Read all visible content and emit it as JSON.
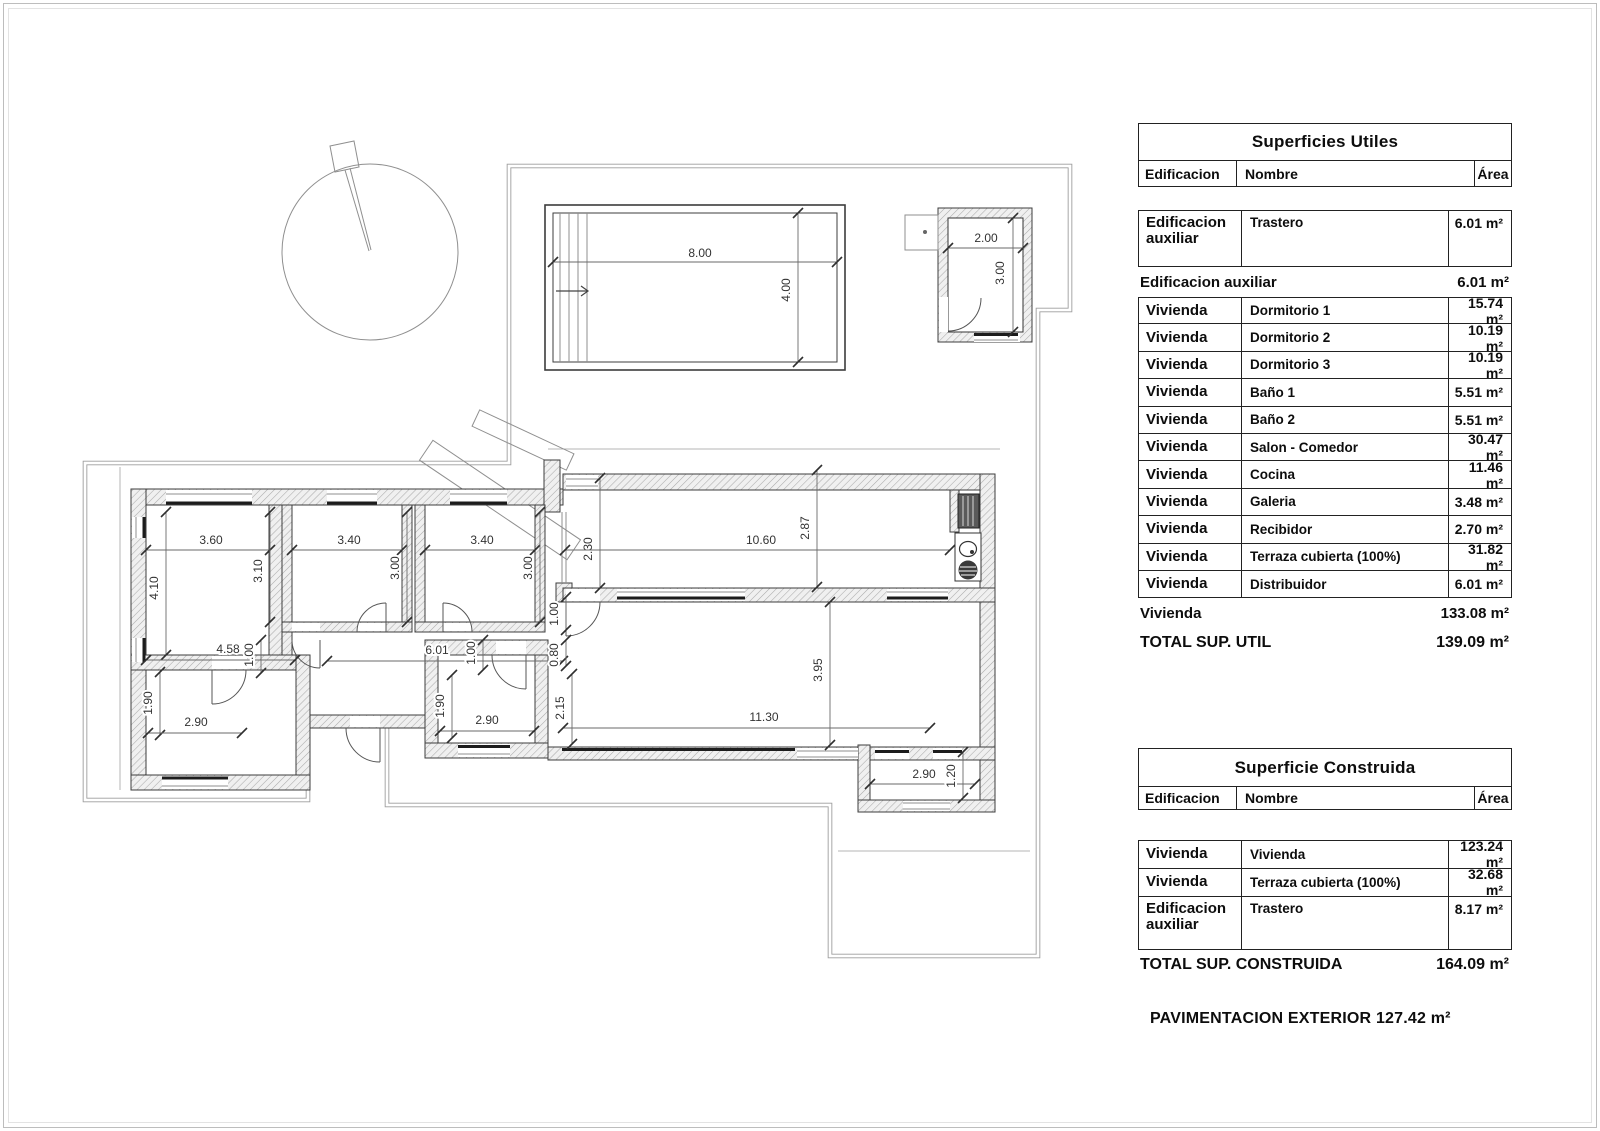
{
  "tables": {
    "utiles": {
      "title": "Superficies Utiles",
      "headers": {
        "edificacion": "Edificacion",
        "nombre": "Nombre",
        "area": "Área"
      },
      "rows": [
        {
          "type": "detail",
          "tall": true,
          "edificacion": "Edificacion auxiliar",
          "nombre": "Trastero",
          "area": "6.01 m²"
        },
        {
          "type": "subtotal",
          "label": "Edificacion auxiliar",
          "area": "6.01 m²"
        },
        {
          "type": "detail",
          "edificacion": "Vivienda",
          "nombre": "Dormitorio 1",
          "area": "15.74 m²"
        },
        {
          "type": "detail",
          "edificacion": "Vivienda",
          "nombre": "Dormitorio 2",
          "area": "10.19 m²"
        },
        {
          "type": "detail",
          "edificacion": "Vivienda",
          "nombre": "Dormitorio 3",
          "area": "10.19 m²"
        },
        {
          "type": "detail",
          "edificacion": "Vivienda",
          "nombre": "Baño 1",
          "area": "5.51 m²"
        },
        {
          "type": "detail",
          "edificacion": "Vivienda",
          "nombre": "Baño 2",
          "area": "5.51 m²"
        },
        {
          "type": "detail",
          "edificacion": "Vivienda",
          "nombre": "Salon - Comedor",
          "area": "30.47 m²"
        },
        {
          "type": "detail",
          "edificacion": "Vivienda",
          "nombre": "Cocina",
          "area": "11.46 m²"
        },
        {
          "type": "detail",
          "edificacion": "Vivienda",
          "nombre": "Galeria",
          "area": "3.48 m²"
        },
        {
          "type": "detail",
          "edificacion": "Vivienda",
          "nombre": "Recibidor",
          "area": "2.70 m²"
        },
        {
          "type": "detail",
          "edificacion": "Vivienda",
          "nombre": "Terraza cubierta (100%)",
          "area": "31.82 m²"
        },
        {
          "type": "detail",
          "edificacion": "Vivienda",
          "nombre": "Distribuidor",
          "area": "6.01 m²"
        },
        {
          "type": "subtotal",
          "label": "Vivienda",
          "area": "133.08 m²"
        },
        {
          "type": "total",
          "label": "TOTAL SUP. UTIL",
          "area": "139.09 m²"
        }
      ]
    },
    "construida": {
      "title": "Superficie Construida",
      "headers": {
        "edificacion": "Edificacion",
        "nombre": "Nombre",
        "area": "Área"
      },
      "rows": [
        {
          "type": "detail",
          "edificacion": "Vivienda",
          "nombre": "Vivienda",
          "area": "123.24 m²"
        },
        {
          "type": "detail",
          "edificacion": "Vivienda",
          "nombre": "Terraza cubierta (100%)",
          "area": "32.68 m²"
        },
        {
          "type": "detail",
          "tall": true,
          "edificacion": "Edificacion auxiliar",
          "nombre": "Trastero",
          "area": "8.17 m²"
        },
        {
          "type": "total",
          "label": "TOTAL SUP. CONSTRUIDA",
          "area": "164.09 m²"
        }
      ]
    }
  },
  "footer": {
    "pavimentacion": "PAVIMENTACION EXTERIOR 127.42 m²"
  },
  "plan": {
    "dimensions": [
      {
        "t": "8.00",
        "x1": 553,
        "y1": 262,
        "x2": 837,
        "y2": 262,
        "lx": 700,
        "ly": 257,
        "v": 0
      },
      {
        "t": "4.00",
        "x1": 798,
        "y1": 213,
        "x2": 798,
        "y2": 362,
        "lx": 790,
        "ly": 290,
        "v": 1
      },
      {
        "t": "2.00",
        "x1": 948,
        "y1": 248,
        "x2": 1023,
        "y2": 248,
        "lx": 986,
        "ly": 242,
        "v": 0
      },
      {
        "t": "3.00",
        "x1": 1013,
        "y1": 218,
        "x2": 1013,
        "y2": 332,
        "lx": 1004,
        "ly": 273,
        "v": 1
      },
      {
        "t": "3.60",
        "x1": 146,
        "y1": 550,
        "x2": 270,
        "y2": 550,
        "lx": 211,
        "ly": 544,
        "v": 0
      },
      {
        "t": "4.10",
        "x1": 166,
        "y1": 512,
        "x2": 166,
        "y2": 655,
        "lx": 158,
        "ly": 588,
        "v": 1
      },
      {
        "t": "3.10",
        "x1": 270,
        "y1": 512,
        "x2": 270,
        "y2": 622,
        "lx": 262,
        "ly": 571,
        "v": 1
      },
      {
        "t": "3.40",
        "x1": 292,
        "y1": 550,
        "x2": 402,
        "y2": 550,
        "lx": 349,
        "ly": 544,
        "v": 0
      },
      {
        "t": "3.00",
        "x1": 407,
        "y1": 512,
        "x2": 407,
        "y2": 622,
        "lx": 399,
        "ly": 568,
        "v": 1
      },
      {
        "t": "3.40",
        "x1": 425,
        "y1": 550,
        "x2": 535,
        "y2": 550,
        "lx": 482,
        "ly": 544,
        "v": 0
      },
      {
        "t": "3.00",
        "x1": 540,
        "y1": 512,
        "x2": 540,
        "y2": 622,
        "lx": 532,
        "ly": 568,
        "v": 1
      },
      {
        "t": "2.30",
        "x1": 600,
        "y1": 478,
        "x2": 600,
        "y2": 588,
        "lx": 592,
        "ly": 549,
        "v": 1
      },
      {
        "t": "10.60",
        "x1": 565,
        "y1": 550,
        "x2": 950,
        "y2": 550,
        "lx": 761,
        "ly": 544,
        "v": 0
      },
      {
        "t": "2.87",
        "x1": 817,
        "y1": 470,
        "x2": 817,
        "y2": 587,
        "lx": 809,
        "ly": 528,
        "v": 1
      },
      {
        "t": "4.58",
        "x1": 146,
        "y1": 660,
        "x2": 295,
        "y2": 660,
        "lx": 228,
        "ly": 653,
        "v": 0
      },
      {
        "t": "1.00",
        "x1": 261,
        "y1": 640,
        "x2": 261,
        "y2": 673,
        "lx": 253,
        "ly": 655,
        "v": 1
      },
      {
        "t": "6.01",
        "x1": 327,
        "y1": 661,
        "x2": 563,
        "y2": 661,
        "lx": 437,
        "ly": 654,
        "v": 0
      },
      {
        "t": "1.00",
        "x1": 483,
        "y1": 640,
        "x2": 483,
        "y2": 670,
        "lx": 475,
        "ly": 653,
        "v": 1
      },
      {
        "t": "1.00",
        "x1": 566,
        "y1": 597,
        "x2": 566,
        "y2": 630,
        "lx": 558,
        "ly": 614,
        "v": 1
      },
      {
        "t": "0.80",
        "x1": 566,
        "y1": 640,
        "x2": 566,
        "y2": 666,
        "lx": 558,
        "ly": 655,
        "v": 1
      },
      {
        "t": "3.95",
        "x1": 830,
        "y1": 602,
        "x2": 830,
        "y2": 745,
        "lx": 822,
        "ly": 670,
        "v": 1
      },
      {
        "t": "11.30",
        "x1": 563,
        "y1": 728,
        "x2": 930,
        "y2": 728,
        "lx": 764,
        "ly": 721,
        "v": 0
      },
      {
        "t": "1.90",
        "x1": 160,
        "y1": 672,
        "x2": 160,
        "y2": 735,
        "lx": 152,
        "ly": 703,
        "v": 1
      },
      {
        "t": "2.90",
        "x1": 148,
        "y1": 733,
        "x2": 242,
        "y2": 733,
        "lx": 196,
        "ly": 726,
        "v": 0
      },
      {
        "t": "1.90",
        "x1": 452,
        "y1": 675,
        "x2": 452,
        "y2": 738,
        "lx": 444,
        "ly": 706,
        "v": 1
      },
      {
        "t": "2.90",
        "x1": 440,
        "y1": 731,
        "x2": 534,
        "y2": 731,
        "lx": 487,
        "ly": 724,
        "v": 0
      },
      {
        "t": "2.15",
        "x1": 572,
        "y1": 674,
        "x2": 572,
        "y2": 744,
        "lx": 564,
        "ly": 708,
        "v": 1
      },
      {
        "t": "2.90",
        "x1": 870,
        "y1": 784,
        "x2": 975,
        "y2": 784,
        "lx": 924,
        "ly": 778,
        "v": 0
      },
      {
        "t": "1.20",
        "x1": 963,
        "y1": 752,
        "x2": 963,
        "y2": 798,
        "lx": 955,
        "ly": 776,
        "v": 1
      }
    ]
  }
}
